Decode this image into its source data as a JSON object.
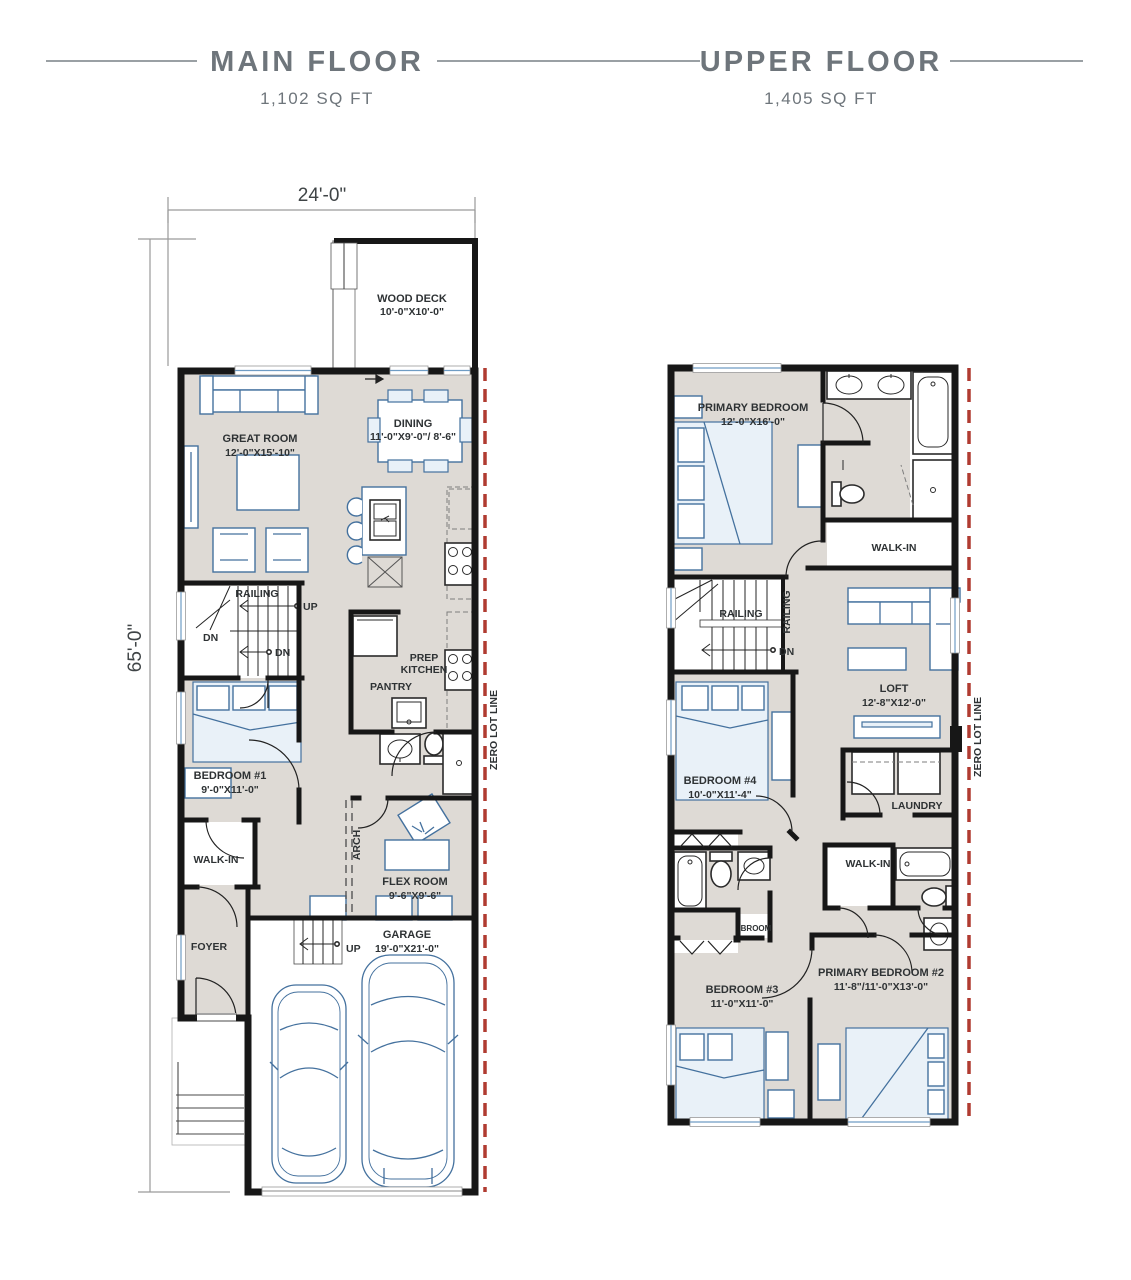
{
  "header": {
    "main_title": "MAIN FLOOR",
    "main_sqft": "1,102 SQ FT",
    "upper_title": "UPPER FLOOR",
    "upper_sqft": "1,405 SQ FT"
  },
  "dims": {
    "width": "24'-0\"",
    "height": "65'-0\""
  },
  "main": {
    "lot": "ZERO LOT LINE",
    "wood_deck_name": "WOOD DECK",
    "wood_deck_dims": "10'-0\"X10'-0\"",
    "great_room_name": "GREAT ROOM",
    "great_room_dims": "12'-0\"X15'-10\"",
    "dining_name": "DINING",
    "dining_dims": "11'-0\"X9'-0\"/ 8'-6\"",
    "railing": "RAILING",
    "up": "UP",
    "dn": "DN",
    "dn2": "DN",
    "prep1": "PREP",
    "prep2": "KITCHEN",
    "pantry": "PANTRY",
    "bed1_name": "BEDROOM #1",
    "bed1_dims": "9'-0\"X11'-0\"",
    "walkin": "WALK-IN",
    "arch": "ARCH",
    "flex_name": "FLEX ROOM",
    "flex_dims": "9'-6\"X9'-6\"",
    "foyer": "FOYER",
    "up2": "UP",
    "garage_name": "GARAGE",
    "garage_dims": "19'-0\"X21'-0\""
  },
  "upper": {
    "lot": "ZERO LOT LINE",
    "primary_name": "PRIMARY BEDROOM",
    "primary_dims": "12'-0\"X16'-0\"",
    "walkin1": "WALK-IN",
    "railing": "RAILING",
    "railing2": "RAILING",
    "dn": "DN",
    "loft_name": "LOFT",
    "loft_dims": "12'-8\"X12'-0\"",
    "bed4_name": "BEDROOM #4",
    "bed4_dims": "10'-0\"X11'-4\"",
    "laundry": "LAUNDRY",
    "walkin2": "WALK-IN",
    "broom": "BROOM",
    "bed3_name": "BEDROOM #3",
    "bed3_dims": "11'-0\"X11'-0\"",
    "primary2_name": "PRIMARY BEDROOM #2",
    "primary2_dims": "11'-8\"/11'-0\"X13'-0\""
  },
  "colors": {
    "wall": "#171717",
    "floor": "#dedad5",
    "furniture": "#44719e",
    "lot_line": "#b03b31",
    "title": "#6e757b"
  }
}
